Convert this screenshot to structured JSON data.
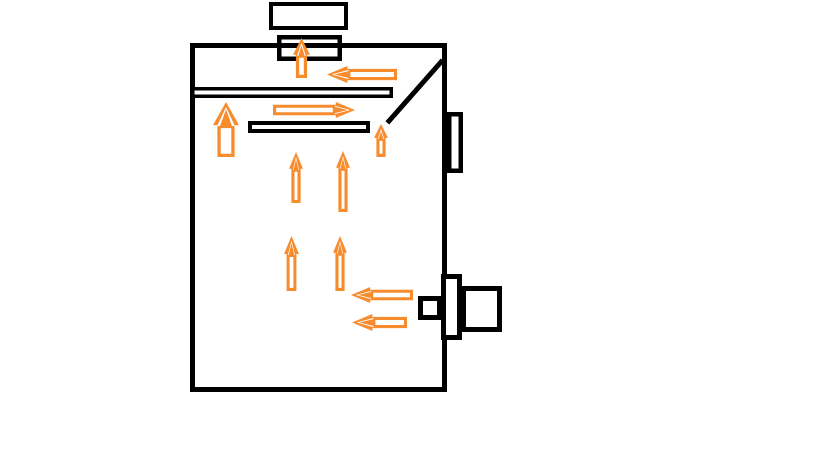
{
  "canvas": {
    "width": 816,
    "height": 460,
    "background": "#ffffff"
  },
  "palette": {
    "line": "#000000",
    "arrow": "#f78c2e",
    "fill": "#ffffff"
  },
  "diagram": {
    "rects": [
      {
        "name": "furnace-body",
        "x": 190,
        "y": 43,
        "w": 257,
        "h": 349,
        "sw": 5,
        "fill": "#ffffff"
      },
      {
        "name": "chimney-cap",
        "x": 269,
        "y": 2,
        "w": 79,
        "h": 28,
        "sw": 4,
        "fill": "#ffffff"
      },
      {
        "name": "chimney-duct",
        "x": 277,
        "y": 35,
        "w": 65,
        "h": 26,
        "sw": 4.5,
        "fill": "none"
      },
      {
        "name": "upper-baffle-plate",
        "x": 191,
        "y": 87,
        "w": 202,
        "h": 11,
        "sw": 3.5,
        "fill": "#ffffff"
      },
      {
        "name": "lower-baffle-plate",
        "x": 248,
        "y": 121,
        "w": 122,
        "h": 12,
        "sw": 4,
        "fill": "#ffffff"
      },
      {
        "name": "side-port-upper",
        "x": 447,
        "y": 112,
        "w": 16,
        "h": 61,
        "sw": 4.5,
        "fill": "#ffffff"
      },
      {
        "name": "flue-collar",
        "x": 441,
        "y": 274,
        "w": 21,
        "h": 66,
        "sw": 5,
        "fill": "#ffffff"
      },
      {
        "name": "flue-outer-box",
        "x": 461,
        "y": 286,
        "w": 41,
        "h": 46,
        "sw": 5,
        "fill": "#ffffff"
      },
      {
        "name": "damper-inner-square",
        "x": 418,
        "y": 296,
        "w": 24,
        "h": 24,
        "sw": 5,
        "fill": "#ffffff"
      }
    ],
    "lines": [
      {
        "name": "diagonal-deflector",
        "x1": 441,
        "y1": 62,
        "x2": 389,
        "y2": 121,
        "sw": 5
      }
    ],
    "arrows": [
      {
        "name": "flow-arrow-chimney-up",
        "dir": "up",
        "style": "outline",
        "x": 293,
        "y": 38,
        "w": 17,
        "h": 40
      },
      {
        "name": "flow-arrow-top-left",
        "dir": "left",
        "style": "solid",
        "x": 327,
        "y": 66,
        "w": 70,
        "h": 17
      },
      {
        "name": "flow-arrow-left-riser-up",
        "dir": "up",
        "style": "outline",
        "x": 213,
        "y": 102,
        "w": 26,
        "h": 55
      },
      {
        "name": "flow-arrow-mid-right",
        "dir": "right",
        "style": "solid",
        "x": 273,
        "y": 102,
        "w": 82,
        "h": 16
      },
      {
        "name": "flow-arrow-gap-riser-up",
        "dir": "up",
        "style": "solid",
        "x": 374,
        "y": 124,
        "w": 14,
        "h": 33
      },
      {
        "name": "flow-arrow-flame-up-1",
        "dir": "up",
        "style": "solid",
        "x": 289,
        "y": 152,
        "w": 14,
        "h": 51
      },
      {
        "name": "flow-arrow-flame-up-2",
        "dir": "up",
        "style": "solid",
        "x": 336,
        "y": 151,
        "w": 14,
        "h": 61
      },
      {
        "name": "flow-arrow-flame-up-3",
        "dir": "up",
        "style": "solid",
        "x": 284,
        "y": 236,
        "w": 15,
        "h": 55
      },
      {
        "name": "flow-arrow-flame-up-4",
        "dir": "up",
        "style": "solid",
        "x": 333,
        "y": 236,
        "w": 14,
        "h": 55
      },
      {
        "name": "flow-arrow-inlet-left-1",
        "dir": "left",
        "style": "solid",
        "x": 351,
        "y": 287,
        "w": 62,
        "h": 16
      },
      {
        "name": "flow-arrow-inlet-left-2",
        "dir": "left",
        "style": "solid",
        "x": 352,
        "y": 314,
        "w": 55,
        "h": 17
      }
    ]
  }
}
